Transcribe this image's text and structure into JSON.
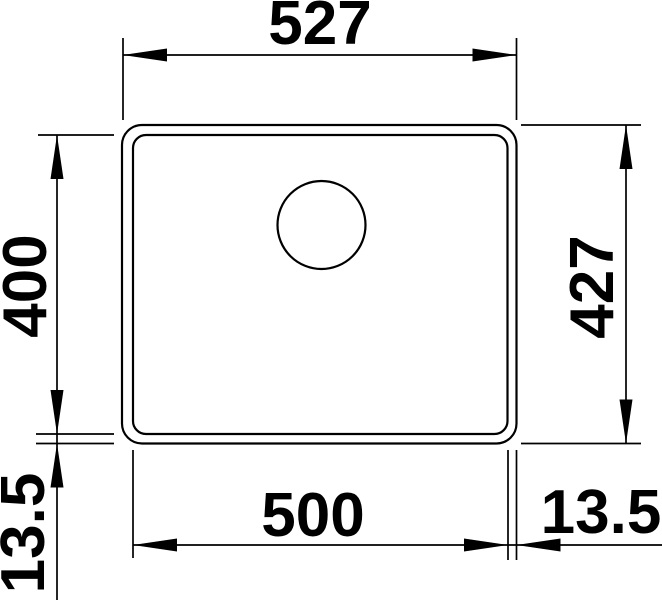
{
  "dimensions": {
    "outer_width": "527",
    "inner_width": "500",
    "inner_height": "400",
    "outer_height": "427",
    "flange_bottom_left": "13.5",
    "flange_right": "13.5"
  },
  "colors": {
    "line": "#000000",
    "background": "#ffffff"
  }
}
